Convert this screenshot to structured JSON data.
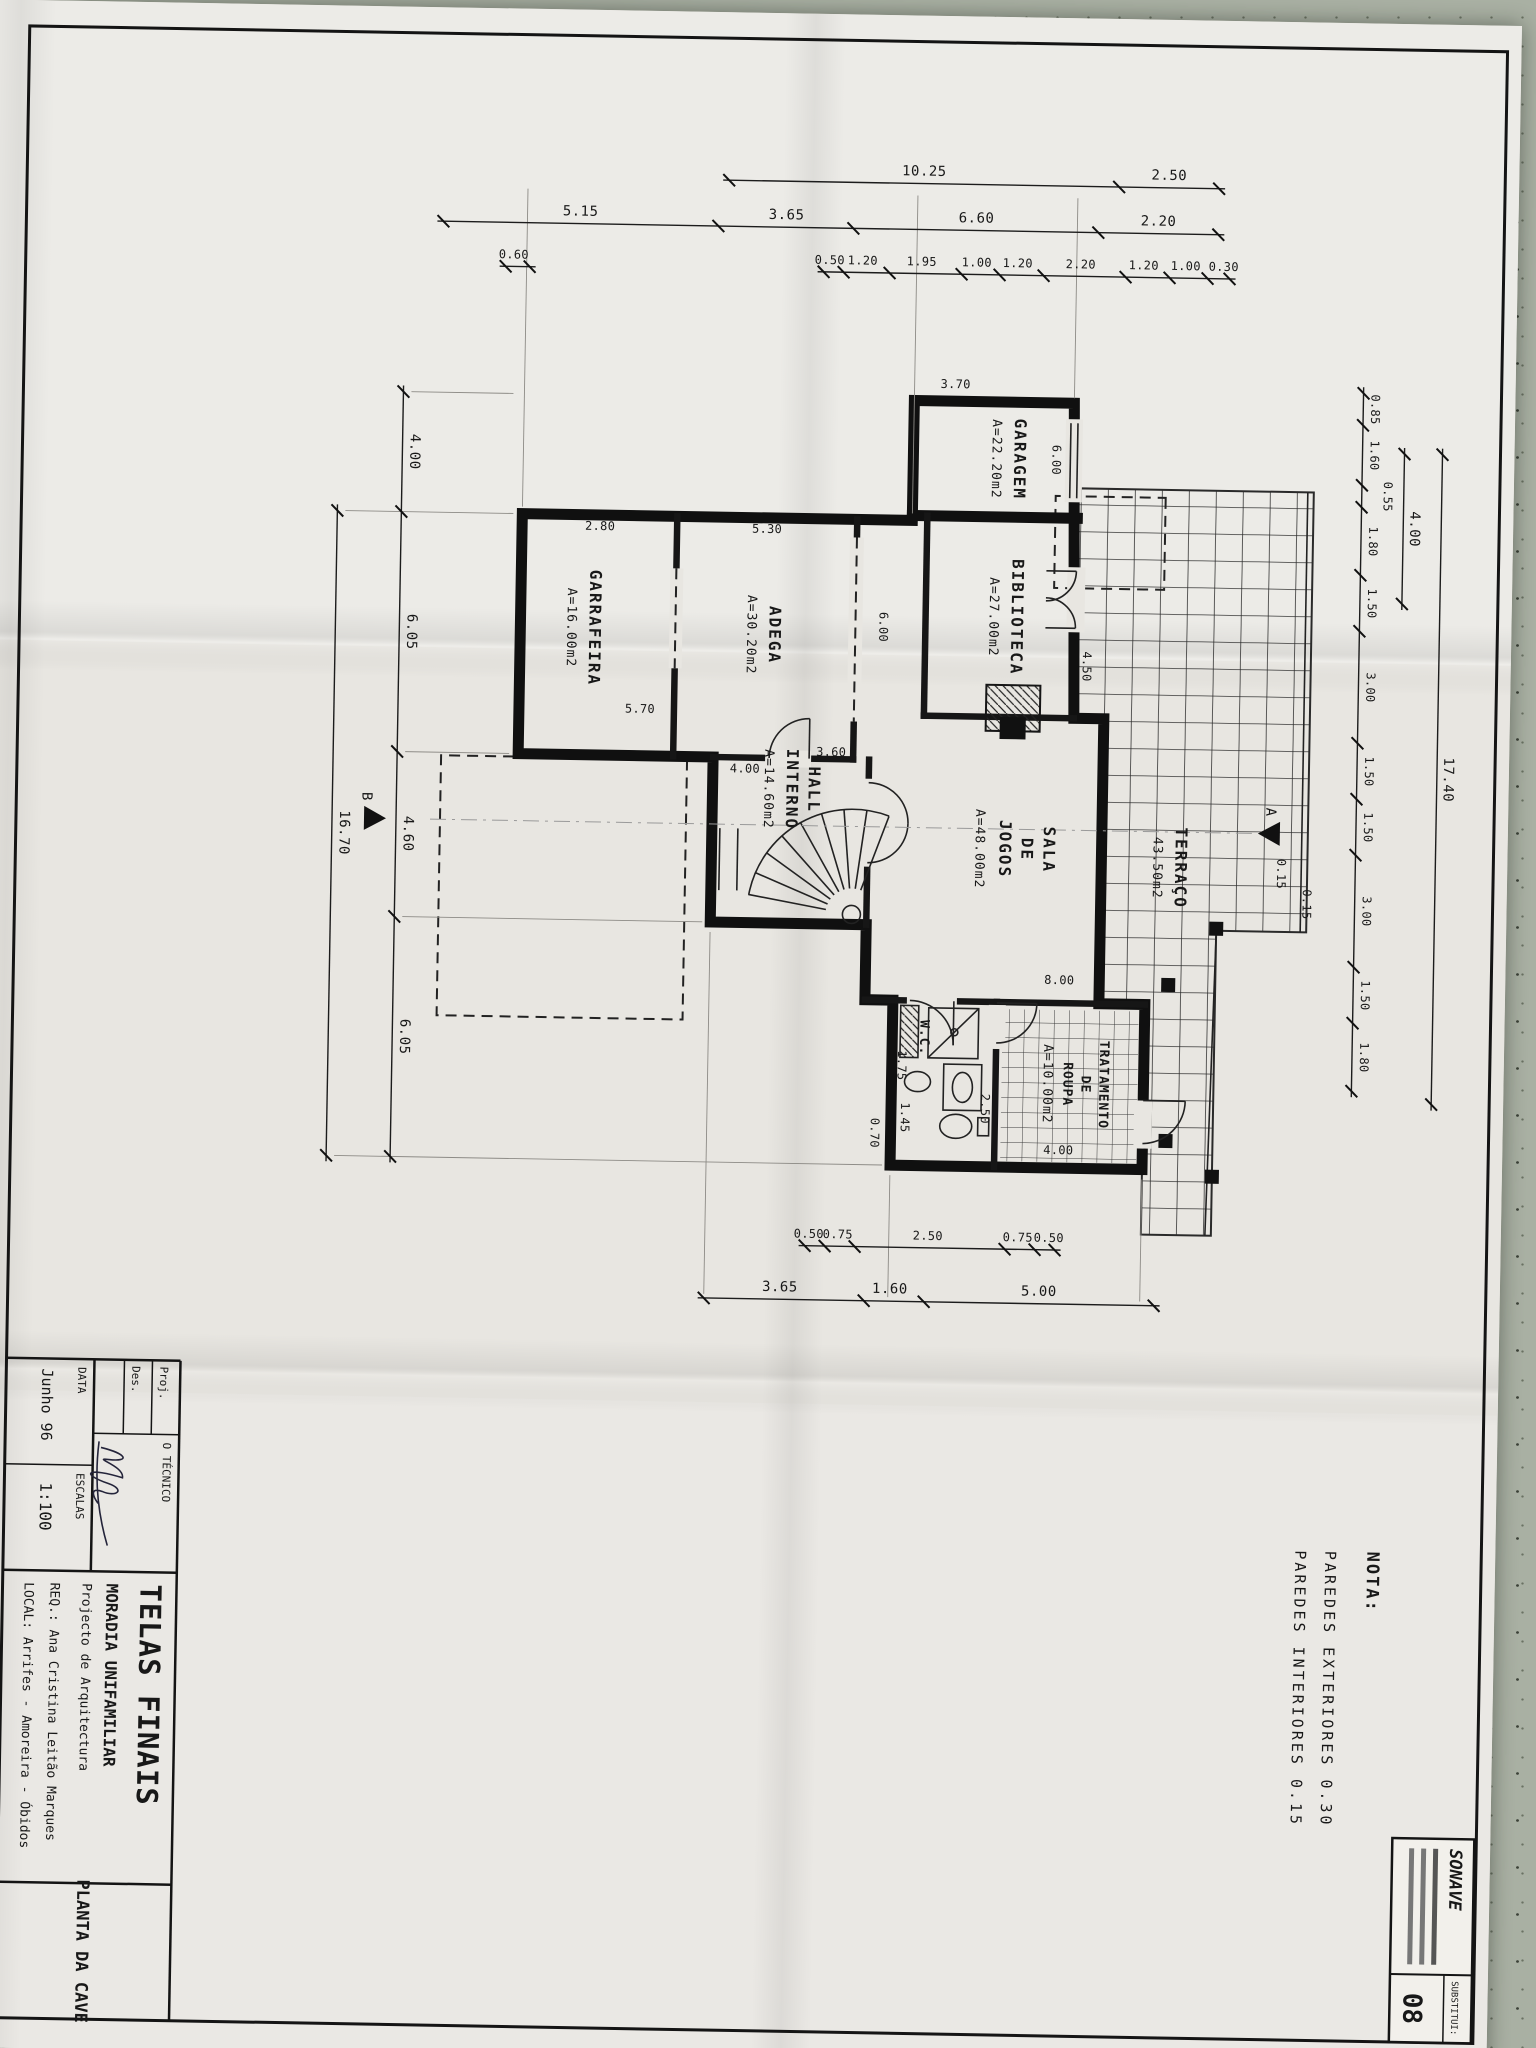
{
  "nota": {
    "heading": "NOTA:",
    "line1": "PAREDES EXTERIORES 0.30",
    "line2": "PAREDES INTERIORES 0.15"
  },
  "title_block": {
    "proj_label": "Proj.",
    "des_label": "Des.",
    "tecnico_label": "O TÉCNICO",
    "data_label": "DATA",
    "data_value": "Junho 96",
    "escalas_label": "ESCALAS",
    "escalas_value": "1:100",
    "main_title": "TELAS FINAIS",
    "subtitle": "MORADIA UNIFAMILIAR",
    "subtitle2": "Projecto de Arquitectura",
    "req": "REQ.: Ana Cristina Leitão Marques",
    "local": "LOCAL: Arrifes - Amoreira - Óbidos",
    "drawing_title": "PLANTA DA CAVE"
  },
  "stamp": {
    "brand": "SONAVE",
    "substitui_label": "SUBSTITUI:",
    "sheet_number": "08"
  },
  "rooms": {
    "garagem": {
      "name": "GARAGEM",
      "area": "A=22.20m2"
    },
    "biblioteca": {
      "name": "BIBLIOTECA",
      "area": "A=27.00m2"
    },
    "adega": {
      "name": "ADEGA",
      "area": "A=30.20m2"
    },
    "garrafeira": {
      "name": "GARRAFEIRA",
      "area": "A=16.00m2"
    },
    "hall": {
      "line1": "HALL",
      "line2": "INTERNO",
      "area": "A=14.60m2"
    },
    "sala": {
      "line1": "SALA",
      "line2": "DE",
      "line3": "JOGOS",
      "area": "A=48.00m2"
    },
    "terraco": {
      "name": "TERRAÇO",
      "area": "43.50m2"
    },
    "tratamento": {
      "line1": "TRATAMENTO",
      "line2": "DE",
      "line3": "ROUPA",
      "area": "A=10.00m2"
    },
    "wc": {
      "name": "W.C."
    }
  },
  "dims": {
    "top_inner": [
      "0.85",
      "1.60",
      "0.55",
      "1.80",
      "1.50",
      "3.00",
      "1.50",
      "1.50",
      "3.00",
      "1.50",
      "1.80"
    ],
    "top_mid": [
      "4.00"
    ],
    "top_outer": [
      "17.40"
    ],
    "left_outer": [
      "2.50",
      "10.25"
    ],
    "left_mid": [
      "2.20",
      "6.60",
      "3.65",
      "5.15"
    ],
    "left_inner": [
      "0.30",
      "1.00",
      "1.20",
      "2.20",
      "1.20",
      "1.00",
      "1.95",
      "1.20",
      "0.50",
      "0.60"
    ],
    "right_inner": [
      "0.50",
      "0.75",
      "2.50",
      "0.75",
      "0.50"
    ],
    "right_outer": [
      "5.00",
      "1.60",
      "3.65"
    ],
    "bottom_inner": [
      "4.00",
      "6.05",
      "4.60",
      "6.05"
    ],
    "bottom_outer": [
      "16.70"
    ],
    "interior": {
      "garagem_w_a": "6.00",
      "garagem_w_b": "6.00",
      "garagem_d": "3.70",
      "terraco_edge": "4.50",
      "garrafeira_w": "2.80",
      "adega_w": "5.30",
      "adega_d": "5.70",
      "hall_w": "3.60",
      "hall_d": "4.00",
      "sala_d": "8.00",
      "wc_a": "1.45",
      "wc_b": "1.75",
      "wc_c": "2.50",
      "wc_d": "0.70",
      "trat_w": "4.00",
      "wall_a": "0.15",
      "wall_b": "0.15"
    },
    "section_a": "A",
    "section_b": "B"
  }
}
